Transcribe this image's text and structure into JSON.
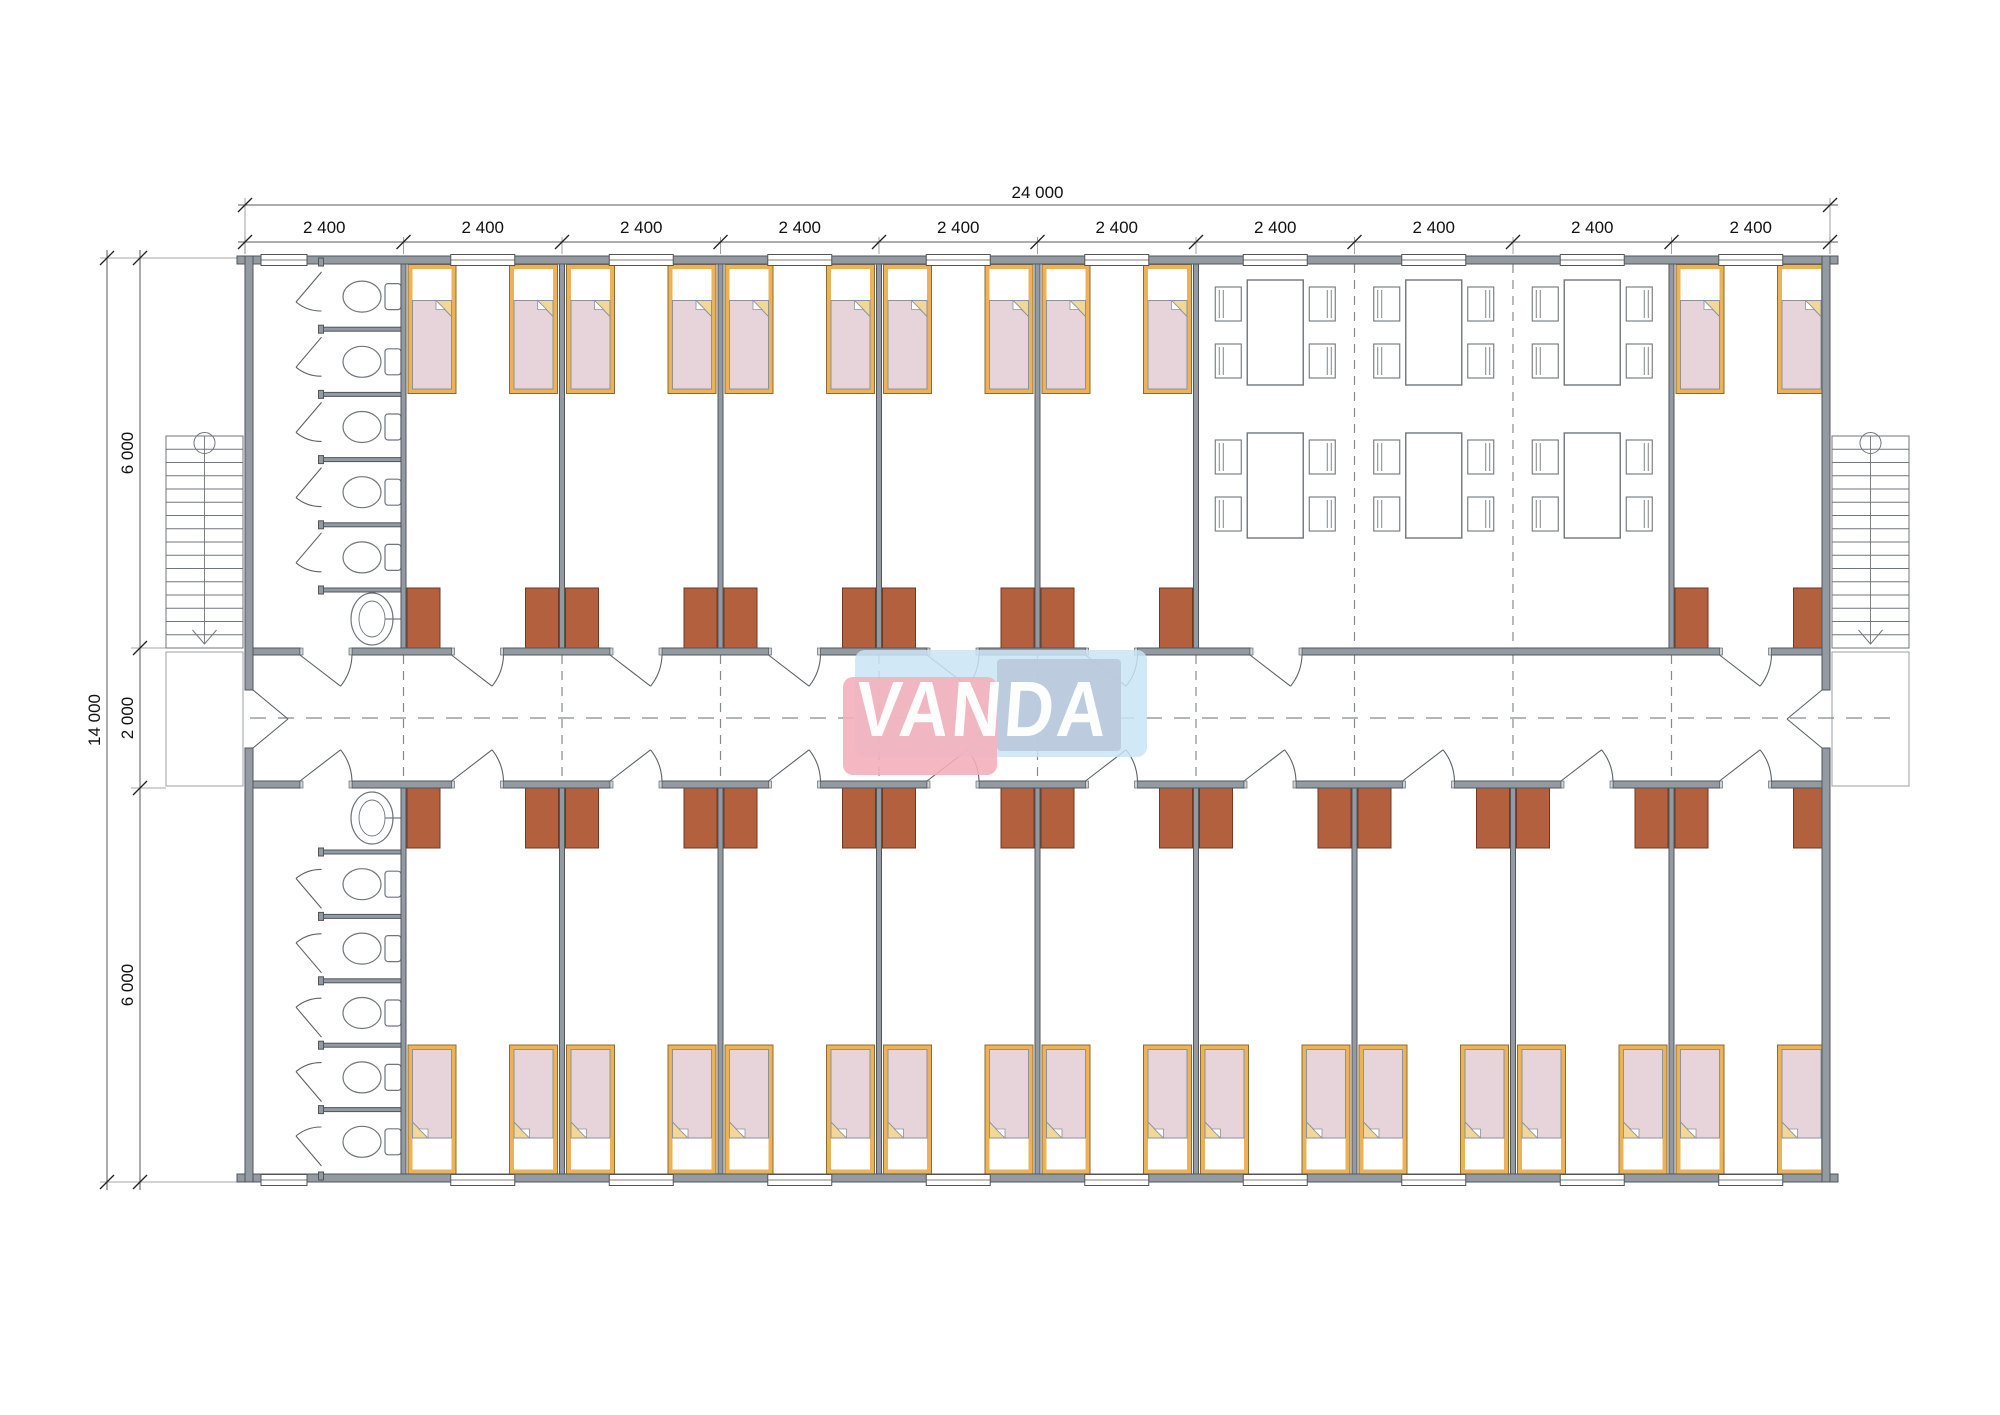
{
  "watermark": {
    "text": "VANDA",
    "pink": "#f4aeba",
    "blue_light": "#c9e4f5",
    "blue_mid": "#b9c9dc",
    "text_color": "#ffffff"
  },
  "dimensions": {
    "top_total_label": "24 000",
    "top_segment_label": "2 400",
    "top_segment_count": 10,
    "left_total_label": "14 000",
    "left_segment_labels": [
      "6 000",
      "2 000",
      "6 000"
    ]
  },
  "plan": {
    "building_mm": {
      "width": 24000,
      "depth": 14000,
      "module": 2400,
      "bands_mm": [
        6000,
        2000,
        6000
      ]
    },
    "geometry_px": {
      "left": 245,
      "right": 1830,
      "top": 258,
      "corridor_top": 648,
      "corridor_bottom": 788,
      "bottom": 1182,
      "modules": 10
    },
    "top_band": {
      "sanitary_module": 0,
      "bedroom_modules": [
        1,
        2,
        3,
        4,
        5,
        9
      ],
      "dining_modules": [
        6,
        7,
        8
      ],
      "beds": 12,
      "wardrobes": 12,
      "toilets": 5,
      "sinks": 1,
      "dining_tables": 6,
      "chairs_per_table": 4
    },
    "bottom_band": {
      "sanitary_module": 0,
      "bedroom_modules": [
        1,
        2,
        3,
        4,
        5,
        6,
        7,
        8,
        9
      ],
      "beds": 18,
      "wardrobes": 18,
      "toilets": 5,
      "sinks": 1
    },
    "stairs": {
      "left": true,
      "right": true,
      "treads": 15
    },
    "entrances": 2,
    "colors": {
      "wall_fill": "#939aa2",
      "wall_stroke": "#50565c",
      "jamb_fill": "#cfd4d9",
      "furniture_line": "#70767c",
      "dash_line": "#84898f",
      "dim_line": "#5a5a5a",
      "dim_text": "#111111",
      "bed_frame": "#ecb258",
      "bed_frame_edge": "#8f6b2d",
      "mattress": "#e7d4da",
      "mattress_edge": "#8d939a",
      "fold_cream": "#f2d79b",
      "wardrobe_fill": "#b2603d",
      "wardrobe_edge": "#75371f",
      "landing_line": "#9aa0a6",
      "white": "#ffffff"
    }
  }
}
